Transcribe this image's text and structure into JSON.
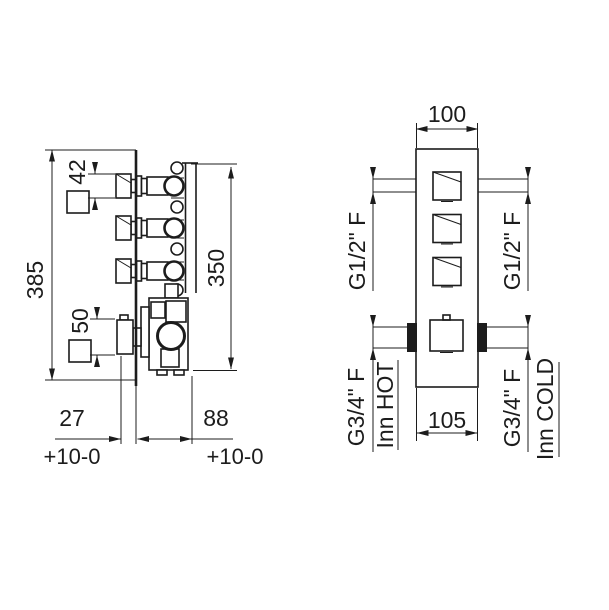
{
  "drawing": {
    "background": "#ffffff",
    "line_color": "#1c1c1c",
    "side_view": {
      "height_overall": "385",
      "handle_square": "42",
      "mixer_square": "50",
      "valve_height": "350",
      "depth_front": "27",
      "depth_front_tol": "+10-0",
      "depth_back": "88",
      "depth_back_tol": "+10-0"
    },
    "front_view": {
      "width_top": "100",
      "width_bottom": "105",
      "outlet_left_thread": "G1/2\" F",
      "outlet_right_thread": "G1/2\" F",
      "inlet_left_thread": "G3/4\" F",
      "inlet_left_name": "Inn HOT",
      "inlet_right_thread": "G3/4\" F",
      "inlet_right_name": "Inn COLD"
    }
  }
}
